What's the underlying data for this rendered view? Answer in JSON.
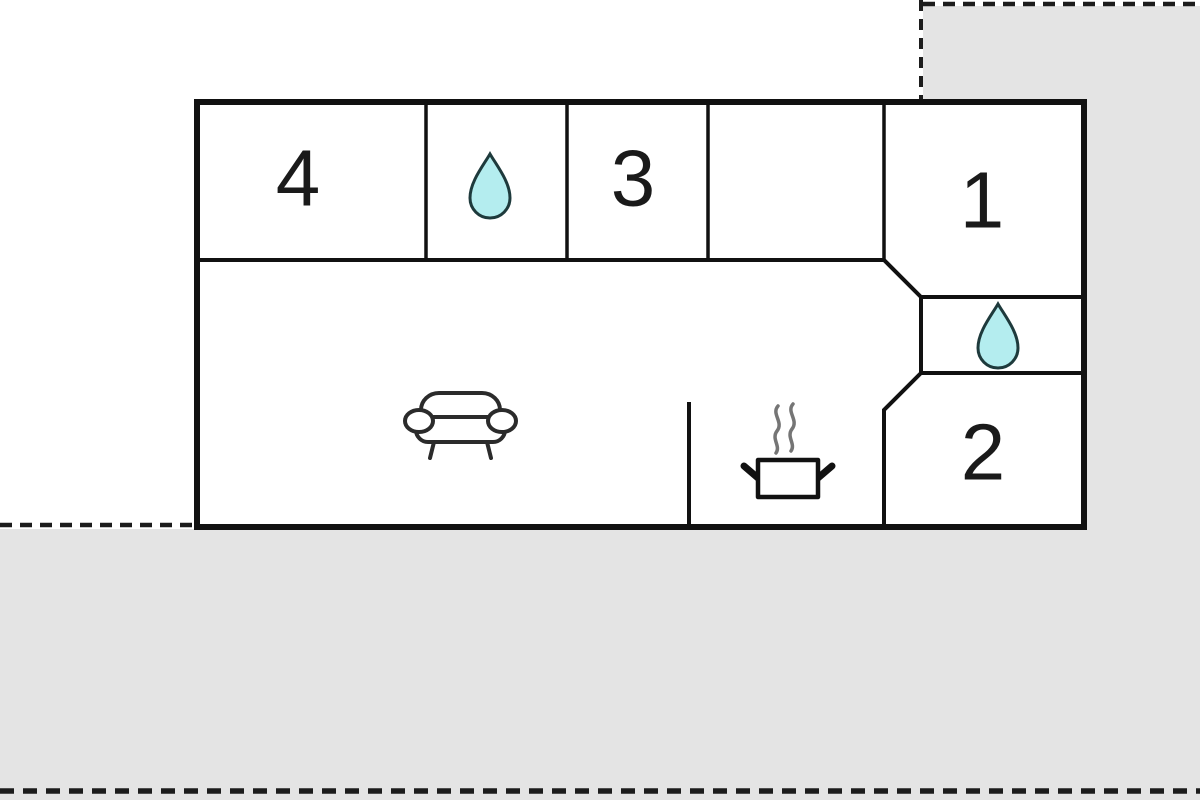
{
  "floor_plan": {
    "rooms": {
      "room_4": {
        "label": "4"
      },
      "room_3": {
        "label": "3"
      },
      "room_1": {
        "label": "1"
      },
      "room_2": {
        "label": "2"
      }
    },
    "icons": {
      "bathroom_top": "water-drop",
      "bathroom_right": "water-drop",
      "living_area": "sofa",
      "kitchen": "steaming-pot"
    }
  },
  "colors": {
    "background": "#ffffff",
    "outside_area": "#e4e4e4",
    "wall": "#111111",
    "boundary_dash": "#1c1c1c",
    "water_drop_fill": "#b4edef",
    "water_drop_stroke": "#1e3a3c",
    "furniture_stroke": "#2b2b2b",
    "steam": "#757575",
    "room_label": "#1a1a1a"
  }
}
